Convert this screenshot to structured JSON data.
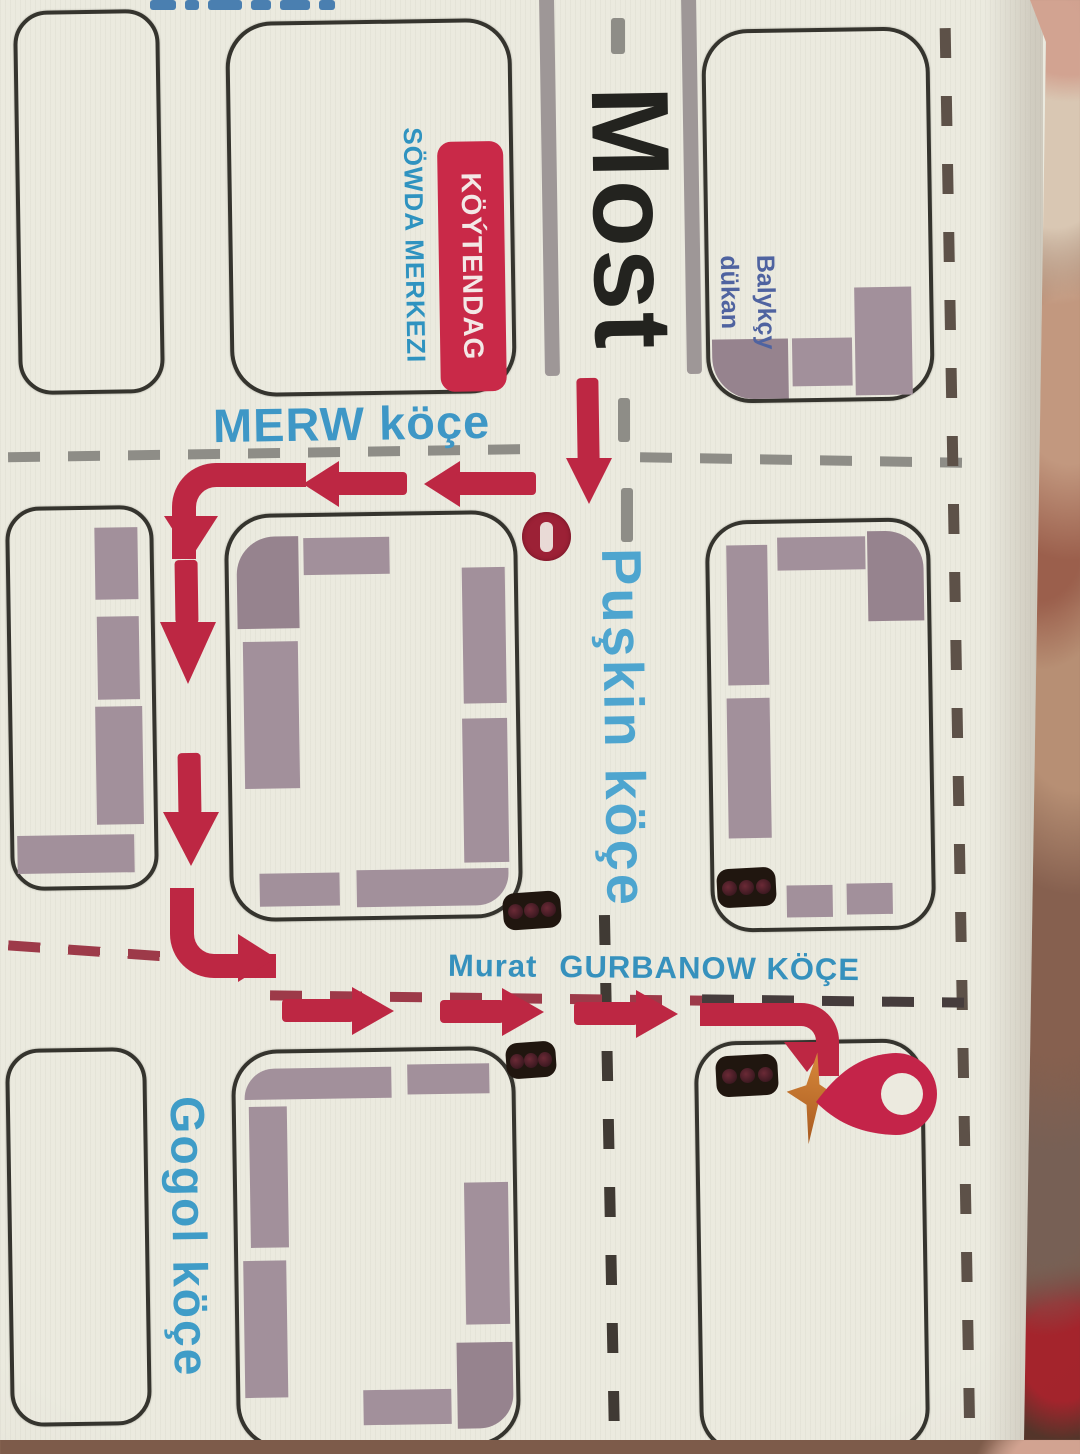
{
  "title": "Hand-drawn city route map (photographed print)",
  "labels": {
    "bridge": "Most",
    "merw": "MERW köçe",
    "puskin": "Puşkin köçe",
    "gogol": "Gogol köçe",
    "murat": "Murat",
    "gurbanow": "GURBANOW KÖÇE",
    "koytendag": "KÖÝTENDAG",
    "sowda": "SÖWDA MERKEZI",
    "balykcy_line1": "Balykçy",
    "balykcy_line2": "dükan"
  },
  "icons": {
    "destination": "map-pin-icon",
    "destination_star": "star-burst-icon",
    "no_entry": "no-entry-icon",
    "traffic_light": "traffic-light-icon"
  },
  "route": {
    "color": "#bd2743",
    "from": "Most (bridge)",
    "to": "red destination pin on Murat Gurbanow köçe",
    "path_summary": "south off the bridge, west along MERW köçe, south past two blocks, east along Murat Gurbanow köçe to the pin"
  },
  "counts": {
    "traffic_lights": 4,
    "city_blocks": 9,
    "route_arrows": 8
  },
  "colors": {
    "paper": "#ebeadf",
    "building_outline": "#35342e",
    "building_block": "#a2909b",
    "label_blue": "#3e97c6",
    "shop_label_blue": "#4f63a0",
    "sign_red": "#c92948",
    "route_red": "#bd2743",
    "dash_gray": "#8e8d87",
    "dash_maroon": "#9d3a49",
    "bridge_gray": "#9e9797",
    "no_entry_red": "#9c2136",
    "pin_red": "#c42449",
    "star_orange": "#d8893b"
  }
}
